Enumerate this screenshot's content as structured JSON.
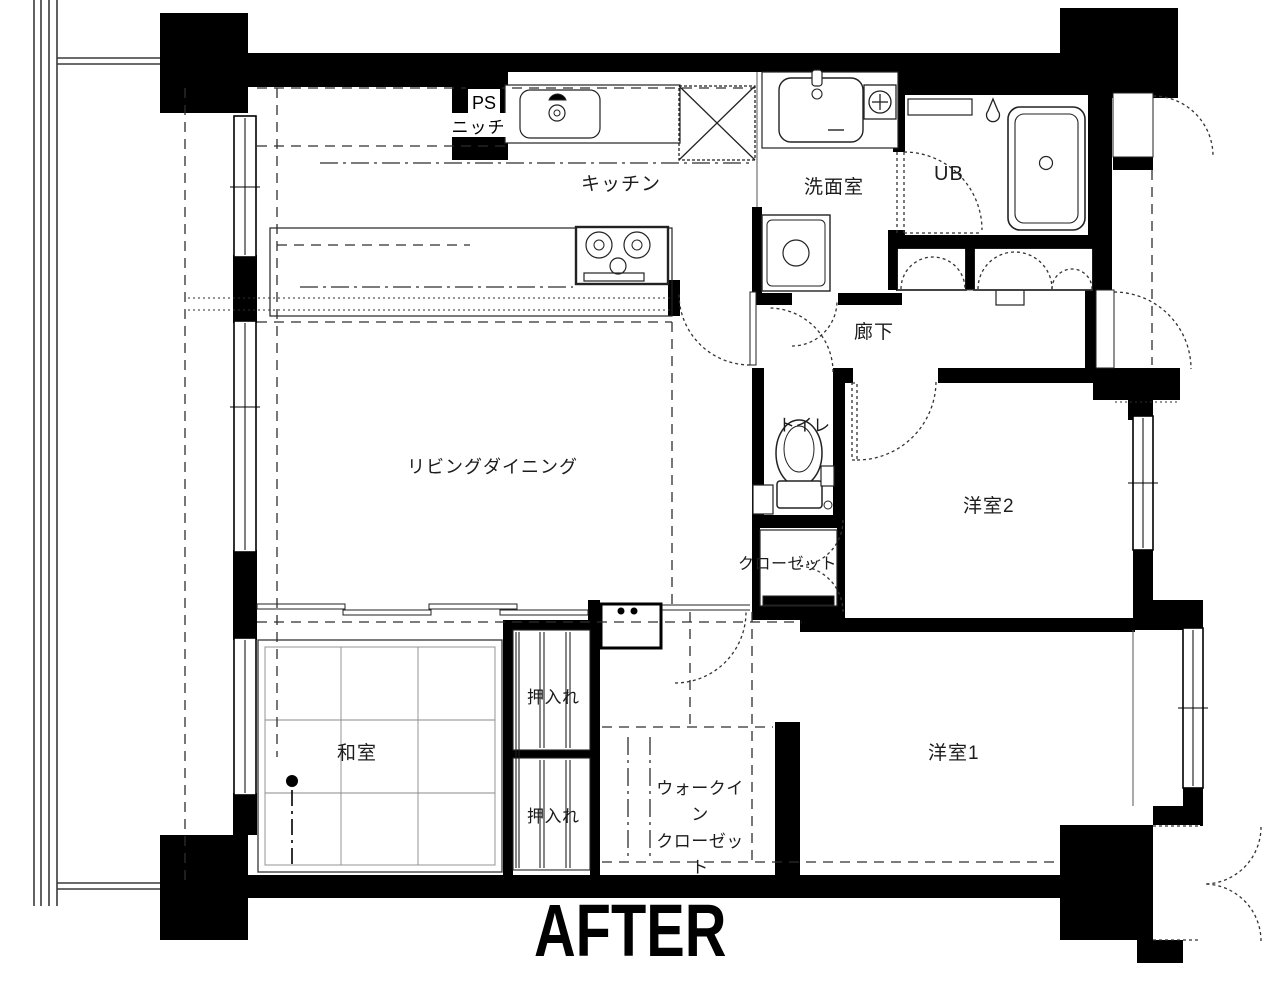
{
  "title": "AFTER",
  "colors": {
    "ink": "#000000",
    "background": "#ffffff"
  },
  "labels": {
    "ps": "PS",
    "niche": "ニッチ",
    "kitchen": "キッチン",
    "washroom": "洗面室",
    "unit_bath": "UB",
    "hallway": "廊下",
    "toilet": "トイレ",
    "living_dining": "リビングダイニング",
    "western_room_2": "洋室2",
    "closet": "クローゼット",
    "japanese_room": "和室",
    "oshiire_upper": "押入れ",
    "oshiire_lower": "押入れ",
    "walk_in_closet_line1": "ウォークイン",
    "walk_in_closet_line2": "クローゼット",
    "western_room_1": "洋室1"
  }
}
